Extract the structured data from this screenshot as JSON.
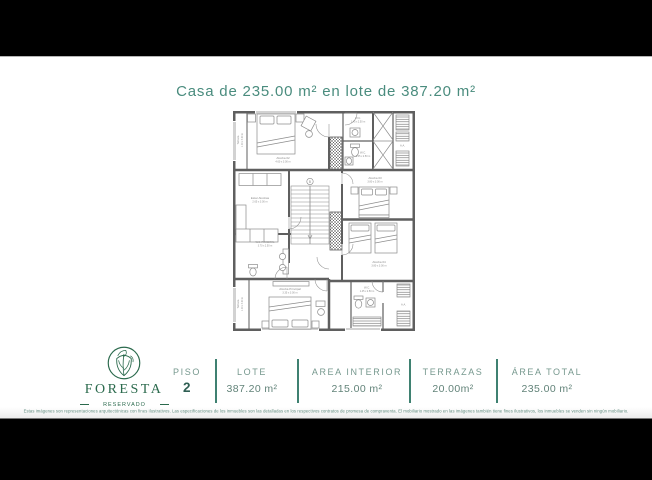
{
  "page": {
    "title": "Casa de 235.00 m² en lote de 387.20 m²"
  },
  "brand": {
    "name": "FORESTA",
    "subtitle": "RESERVADO"
  },
  "summary": {
    "columns": [
      {
        "label": "PISO",
        "value": "2"
      },
      {
        "label": "LOTE",
        "value": "387.20 m²"
      },
      {
        "label": "AREA INTERIOR",
        "value": "215.00 m²"
      },
      {
        "label": "TERRAZAS",
        "value": "20.00m²"
      },
      {
        "label": "ÁREA TOTAL",
        "value": "235.00 m²"
      }
    ]
  },
  "floor_plan": {
    "rooms": [
      {
        "name": "Terraza",
        "dims": "1.00 x 3.00 m"
      },
      {
        "name": "Alcoba 02",
        "dims": "4.60 x 3.00 m"
      },
      {
        "name": "W.C.",
        "dims": "1.45 x 2.50 m"
      },
      {
        "name": "W.C.",
        "dims": "1.45 x 2.50 m"
      },
      {
        "name": "Alcoba 03",
        "dims": "3.80 x 3.00 m"
      },
      {
        "name": "Alcoba 04",
        "dims": "3.80 x 3.00 m"
      },
      {
        "name": "Estar Alcobas",
        "dims": "2.65 x 3.00 m"
      },
      {
        "name": "W.C. PRINCIPAL",
        "dims": "3.70 x 2.50 m"
      },
      {
        "name": "Alcoba Principal",
        "dims": "3.35 x 3.00 m"
      },
      {
        "name": "Terraza",
        "dims": "1.00 x 3.00 m"
      },
      {
        "name": "W.C.",
        "dims": "1.45 x 2.50 m"
      }
    ],
    "annotations": [
      {
        "label": "A.A."
      },
      {
        "label": "A.A."
      },
      {
        "label": "B"
      }
    ]
  },
  "disclaimer": "Estas imágenes son representaciones arquitectónicas con fines ilustrativos. Las especificaciones de los inmuebles son las detalladas en los respectivos contratos de promesa de compraventa. El mobiliario mostrado en las imágenes también tiene fines ilustrativos, los inmuebles se venden sin ningún mobiliario.",
  "colors": {
    "accent_teal": "#4a8c7e",
    "label_teal": "#76988e",
    "value_teal": "#628379",
    "divider_teal": "#3f8171",
    "logo_green": "#2b6a4d",
    "plan_wall": "#5f5f5f",
    "plan_detail": "#8c8c8c",
    "background_bar": "#000000"
  }
}
